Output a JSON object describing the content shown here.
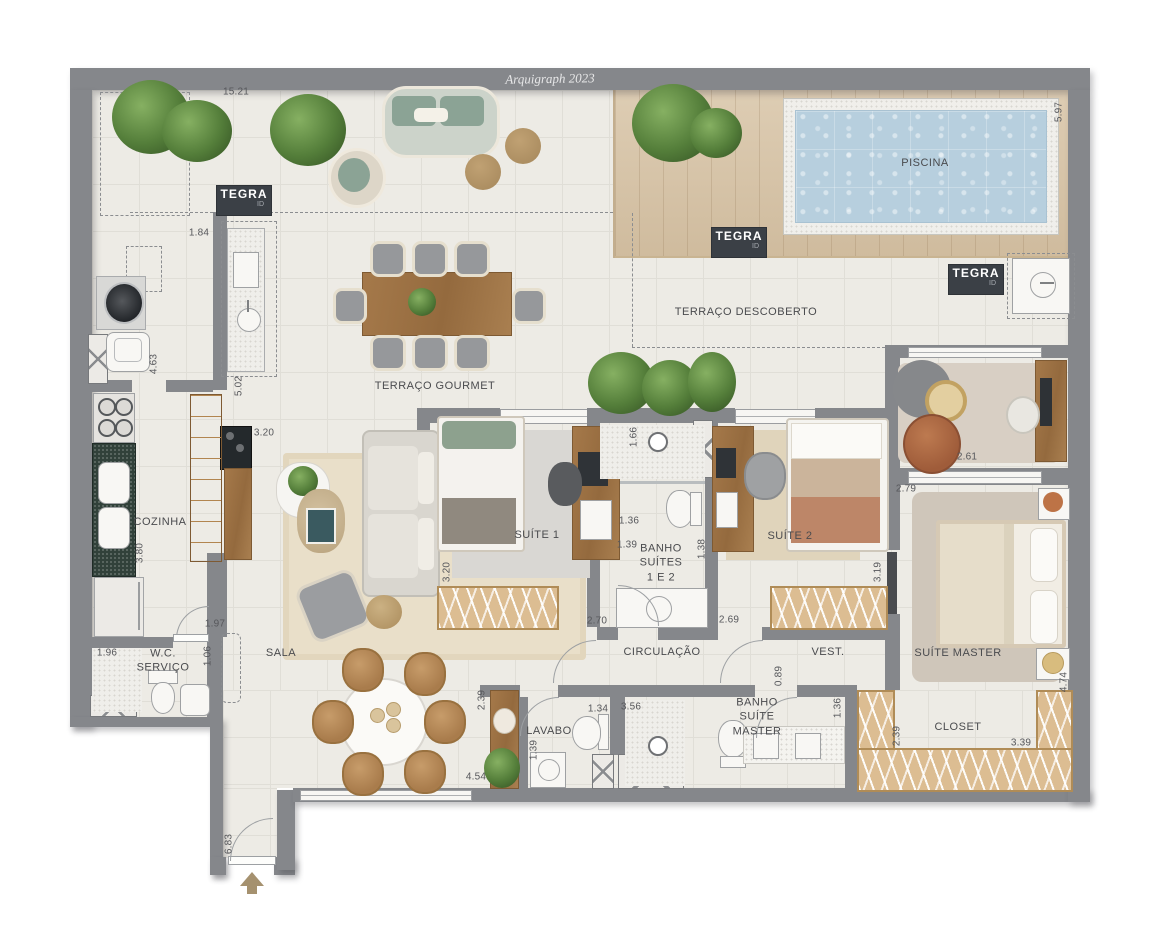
{
  "watermark": "Arquigraph 2023",
  "brand": {
    "name": "TEGRA",
    "id": "ID"
  },
  "rooms": {
    "terraco_gourmet": "TERRAÇO GOURMET",
    "terraco_descoberto": "TERRAÇO DESCOBERTO",
    "piscina": "PISCINA",
    "cozinha": "COZINHA",
    "wc_servico": "W.C.\nSERVIÇO",
    "sala": "SALA",
    "suite_1": "SUÍTE 1",
    "banho_suites": "BANHO\nSUÍTES\n1 E 2",
    "suite_2": "SUÍTE 2",
    "circulacao": "CIRCULAÇÃO",
    "vest": "VEST.",
    "suite_master": "SUÍTE MASTER",
    "lavabo": "LAVABO",
    "banho_suite_master": "BANHO\nSUÍTE\nMASTER",
    "closet": "CLOSET"
  },
  "dimensions": {
    "top_terrace_width": "15.21",
    "deck_depth": "5.97",
    "island_offset": "1.84",
    "service_height": "4.63",
    "gourmet_height": "5.02",
    "sala_width": "3.20",
    "suite1_height": "3.20",
    "cozinha_height": "3.80",
    "kitchen_opening": "1.97",
    "wc_width": "1.96",
    "wc_depth": "1.06",
    "sala_height": "6.83",
    "banho_shower": "1.66",
    "banho_width_a": "1.36",
    "banho_width_b": "1.39",
    "banho_height": "1.38",
    "suite1_width": "2.70",
    "suite2_width": "2.69",
    "suite2_height": "3.19",
    "sitting_width": "2.61",
    "master_width": "2.79",
    "master_door_offset": "0.89",
    "lavabo_width": "1.34",
    "lavabo_height": "1.39",
    "banho_master_width": "3.56",
    "banho_master_height": "1.36",
    "sideboard_height": "2.39",
    "hall_width": "4.54",
    "closet_depth": "2.39",
    "closet_width": "3.39",
    "closet_height": "4.74"
  }
}
